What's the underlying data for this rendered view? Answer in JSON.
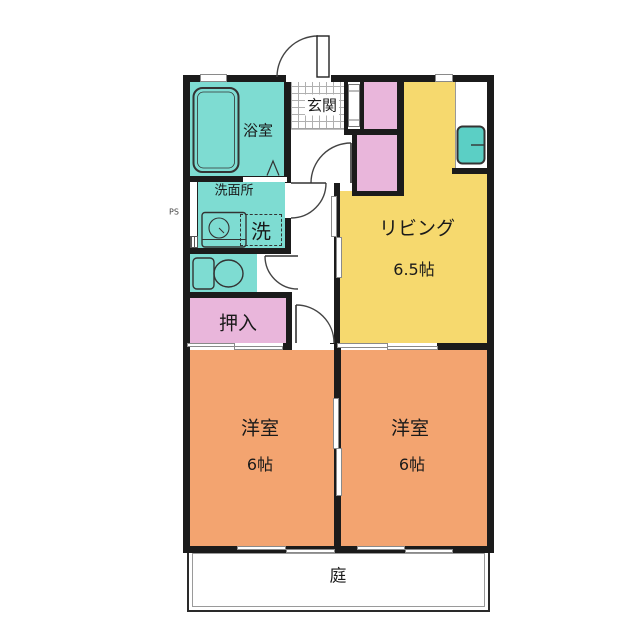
{
  "rooms": {
    "bath": {
      "name": "浴室"
    },
    "washroom": {
      "name": "洗面所"
    },
    "laundry": {
      "name": "洗"
    },
    "pipe_space": {
      "name": "PS"
    },
    "entrance": {
      "name": "玄関"
    },
    "closet": {
      "name": "押入"
    },
    "living": {
      "name": "リビング",
      "size": "6.5帖"
    },
    "bedroom_left": {
      "name": "洋室",
      "size": "6帖"
    },
    "bedroom_right": {
      "name": "洋室",
      "size": "6帖"
    },
    "garden": {
      "name": "庭"
    }
  },
  "colors": {
    "wet_area_teal": "#7EDCD2",
    "living_yellow": "#F6D96E",
    "closet_pink": "#E9B6DB",
    "bedroom_orange": "#F3A470",
    "fixture_teal": "#5BCFC5",
    "wall_black": "#1B1B1B"
  }
}
